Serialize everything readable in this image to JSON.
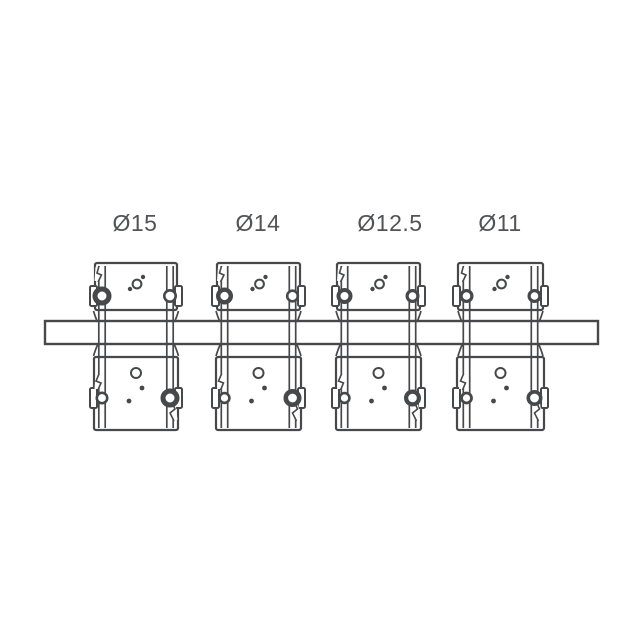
{
  "page": {
    "background": "#ffffff"
  },
  "diagram": {
    "kind": "technical-line-drawing",
    "subject": "four shaft clamp blocks on a mounting rail with diameter callouts",
    "stroke_color": "#47484a",
    "label_color": "#525356",
    "label_font_size": 23,
    "label_baseline_y": 231,
    "canvas": {
      "width": 640,
      "height": 640
    },
    "rail": {
      "x": 45,
      "y": 321,
      "width": 553,
      "height": 23,
      "stroke_width": 2.4
    },
    "geometry": {
      "top_block": {
        "y": 263,
        "height": 47,
        "corner_radius": 2,
        "stroke_width": 2.2
      },
      "bottom_block": {
        "y": 357,
        "height": 73,
        "corner_radius": 2,
        "stroke_width": 2.2,
        "extra_half_width": 1
      },
      "bolt_offset_x": 34,
      "top_bolt_y": 296,
      "bottom_bolt_y": 398,
      "screw_line_half_gap": 3.2,
      "screw_line_stroke": 1.7,
      "screw_top_y": 266,
      "screw_bottom_y": 428,
      "lug": {
        "protrude": 5,
        "half_height": 10,
        "corner_radius": 1.5,
        "stroke_width": 2
      },
      "flare": {
        "offset_out": 8.5,
        "depth": 11,
        "pull": 2
      },
      "top_holes": [
        {
          "dx": -6,
          "y": 289,
          "r": 2.2,
          "filled": true
        },
        {
          "dx": 1,
          "y": 284,
          "r": 4.4,
          "filled": false
        },
        {
          "dx": 7,
          "y": 277,
          "r": 2.2,
          "filled": true
        }
      ],
      "bottom_holes": [
        {
          "dx": 0,
          "y": 373,
          "r": 5.0,
          "filled": false
        },
        {
          "dx": 6,
          "y": 388,
          "r": 2.4,
          "filled": true
        },
        {
          "dx": -7,
          "y": 401,
          "r": 2.4,
          "filled": true
        }
      ],
      "breaks": {
        "top_left": [
          [
            -37,
            266
          ],
          [
            -39,
            273
          ],
          [
            -34.5,
            275
          ],
          [
            -38,
            282
          ]
        ],
        "bottom_left": [
          [
            -37,
            374
          ],
          [
            -40,
            381
          ],
          [
            -35,
            383
          ],
          [
            -38,
            390
          ]
        ],
        "bottom_right": [
          [
            36,
            402
          ],
          [
            39,
            409
          ],
          [
            34,
            413
          ],
          [
            38,
            421
          ]
        ]
      }
    },
    "clamps": [
      {
        "label": "Ø15",
        "cx": 136,
        "label_cx": 135,
        "half_width": 41,
        "bolts": {
          "top_left": {
            "r": 9.5,
            "ring": 5.0
          },
          "top_right": {
            "r": 7.0,
            "ring": 2.6
          },
          "bottom_left": {
            "r": 6.5,
            "ring": 2.6
          },
          "bottom_right": {
            "r": 9.5,
            "ring": 5.0
          }
        }
      },
      {
        "label": "Ø14",
        "cx": 258.5,
        "label_cx": 258,
        "half_width": 41.5,
        "bolts": {
          "top_left": {
            "r": 8.5,
            "ring": 4.4
          },
          "top_right": {
            "r": 6.6,
            "ring": 2.6
          },
          "bottom_left": {
            "r": 6.2,
            "ring": 2.6
          },
          "bottom_right": {
            "r": 9.0,
            "ring": 4.6
          }
        }
      },
      {
        "label": "Ø12.5",
        "cx": 378.5,
        "label_cx": 390,
        "half_width": 41.5,
        "bolts": {
          "top_left": {
            "r": 8.0,
            "ring": 4.0
          },
          "top_right": {
            "r": 7.0,
            "ring": 3.2
          },
          "bottom_left": {
            "r": 6.2,
            "ring": 2.6
          },
          "bottom_right": {
            "r": 8.5,
            "ring": 4.2
          }
        }
      },
      {
        "label": "Ø11",
        "cx": 500.5,
        "label_cx": 500,
        "half_width": 42.5,
        "bolts": {
          "top_left": {
            "r": 7.0,
            "ring": 3.2
          },
          "top_right": {
            "r": 7.0,
            "ring": 3.2
          },
          "bottom_left": {
            "r": 6.4,
            "ring": 2.8
          },
          "bottom_right": {
            "r": 8.0,
            "ring": 3.6
          }
        }
      }
    ]
  }
}
